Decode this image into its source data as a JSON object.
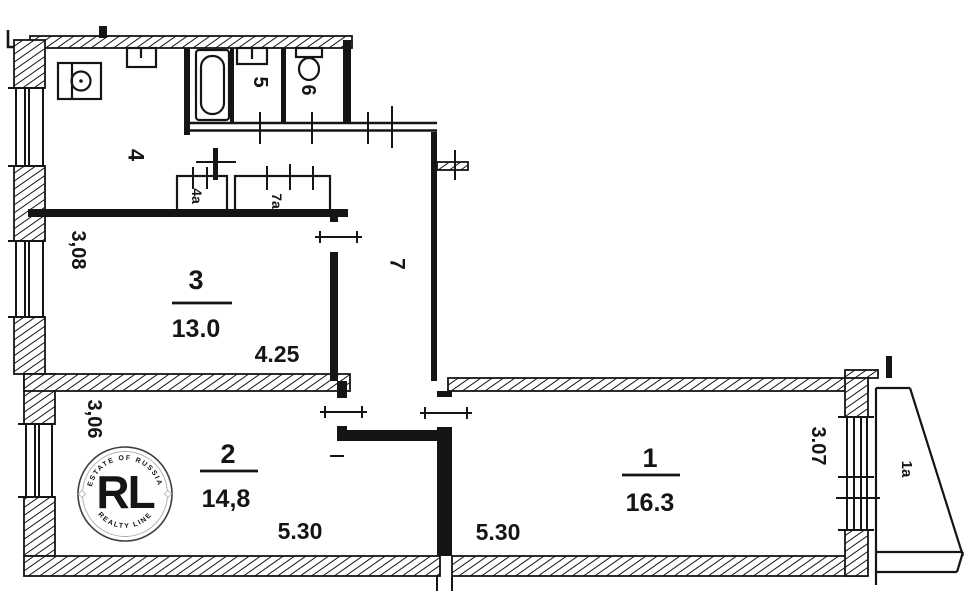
{
  "rooms": {
    "r1": {
      "number": "1",
      "area": "16.3",
      "width": "5.30",
      "height": "3.07"
    },
    "r2": {
      "number": "2",
      "area": "14,8",
      "width": "5.30",
      "height": "3,06"
    },
    "r3": {
      "number": "3",
      "area": "13.0",
      "width": "4.25",
      "height": "3,08"
    },
    "r4": {
      "number": "4"
    },
    "r5": {
      "number": "5"
    },
    "r6": {
      "number": "6"
    },
    "r7": {
      "number": "7"
    },
    "c4a": {
      "number": "4а"
    },
    "c7a": {
      "number": "7а"
    },
    "b1a": {
      "number": "1а"
    }
  },
  "watermark": {
    "monogram": "RL",
    "arc_top": "ESTATE OF RUSSIA",
    "arc_bottom": "REALTY LINE",
    "gold": "#bf9140",
    "ring": "#3f3f3f"
  },
  "colors": {
    "ink": "#151515",
    "paper": "#ffffff"
  }
}
